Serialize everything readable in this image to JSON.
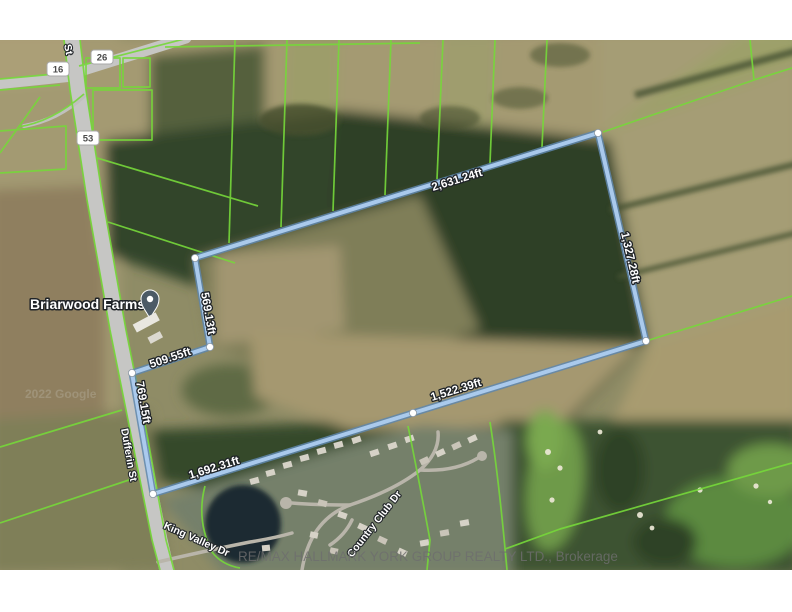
{
  "map": {
    "place_label": "Briarwood Farms",
    "street_labels": {
      "dufferin": "Dufferin St",
      "king_valley": "King Valley Dr",
      "country_club": "Country Club Dr",
      "st_fragment": "St"
    },
    "route_badges": [
      {
        "id": "16"
      },
      {
        "id": "26"
      },
      {
        "id": "53"
      }
    ],
    "measurements": {
      "top": "2,631.24ft",
      "right": "1,327.28ft",
      "bottom_right": "1,522.39ft",
      "bottom_left": "1,692.31ft",
      "road": "769.15ft",
      "west_inner": "509.55ft",
      "north_inner": "569.13ft"
    },
    "watermarks": {
      "brokerage": "RE/MAX HALLMARK YORK GROUP REALTY LTD., Brokerage",
      "imagery": "2022 Google"
    },
    "colors": {
      "boundary_blue": "#aecdf0",
      "boundary_casing": "#5e86ad",
      "parcel_green": "#76d83a",
      "road_grey": "#c6c6c4",
      "pin": "#4c5a66"
    }
  }
}
